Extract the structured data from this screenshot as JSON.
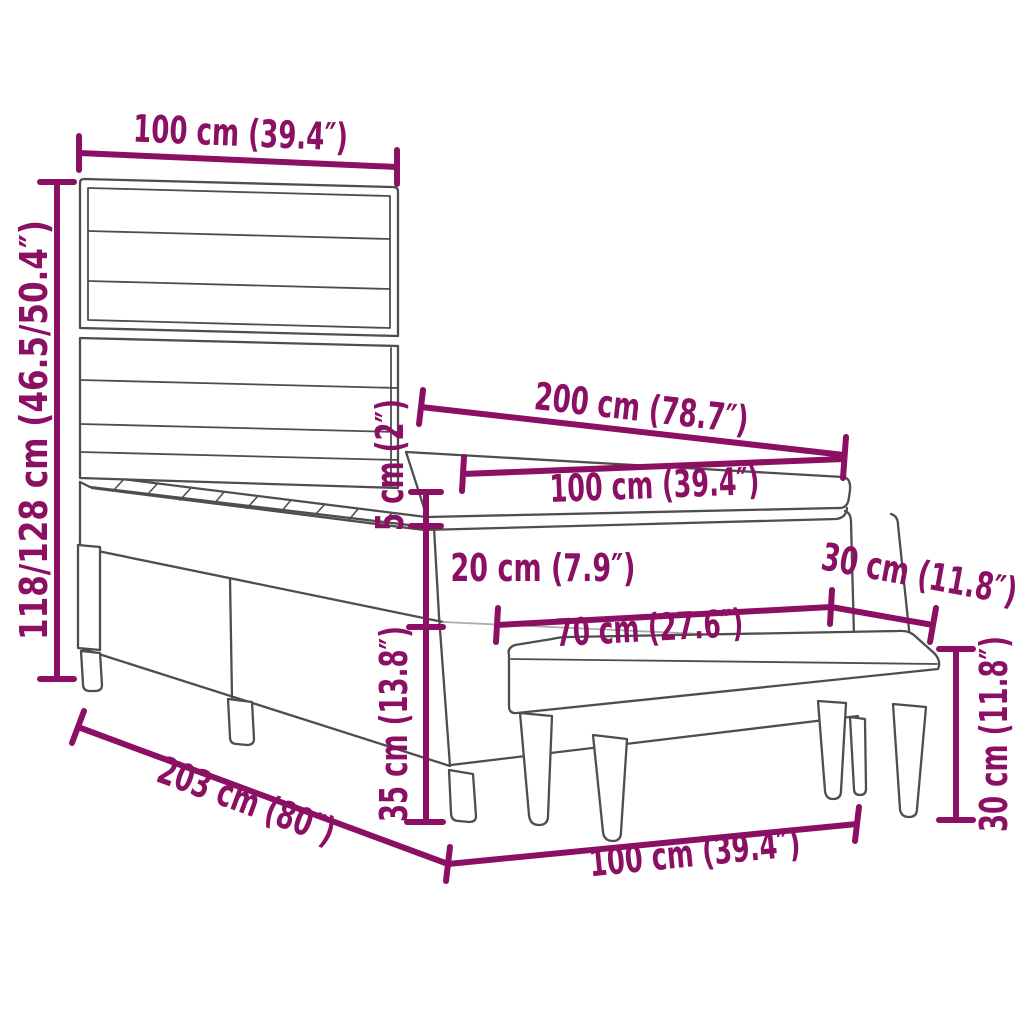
{
  "diagram": {
    "kind": "furniture-dimension-diagram",
    "subject": "box spring bed with headboard, mattress topper and bench",
    "accent_color": "#8B0F63",
    "outline_color": "#4E4E4E",
    "light_line_color": "#ABABAB",
    "background_color": "#FFFFFF",
    "dims": [
      {
        "id": "headboard-width",
        "label": "100 cm (39.4″)"
      },
      {
        "id": "headboard-height",
        "label": "118/128 cm (46.5/50.4″)"
      },
      {
        "id": "bed-length",
        "label": "200 cm (78.7″)"
      },
      {
        "id": "mattress-width",
        "label": "100 cm (39.4″)"
      },
      {
        "id": "topper-height",
        "label": "5 cm (2″)"
      },
      {
        "id": "boxspring-height",
        "label": "20 cm (7.9″)"
      },
      {
        "id": "bench-depth",
        "label": "30 cm (11.8″)"
      },
      {
        "id": "bench-seat-width",
        "label": "70 cm (27.6″)"
      },
      {
        "id": "frame-height",
        "label": "35 cm (13.8″)"
      },
      {
        "id": "bed-total-length",
        "label": "203 cm (80″)"
      },
      {
        "id": "bench-total-width",
        "label": "100 cm (39.4″)"
      },
      {
        "id": "bench-height",
        "label": "30 cm (11.8″)"
      }
    ]
  }
}
